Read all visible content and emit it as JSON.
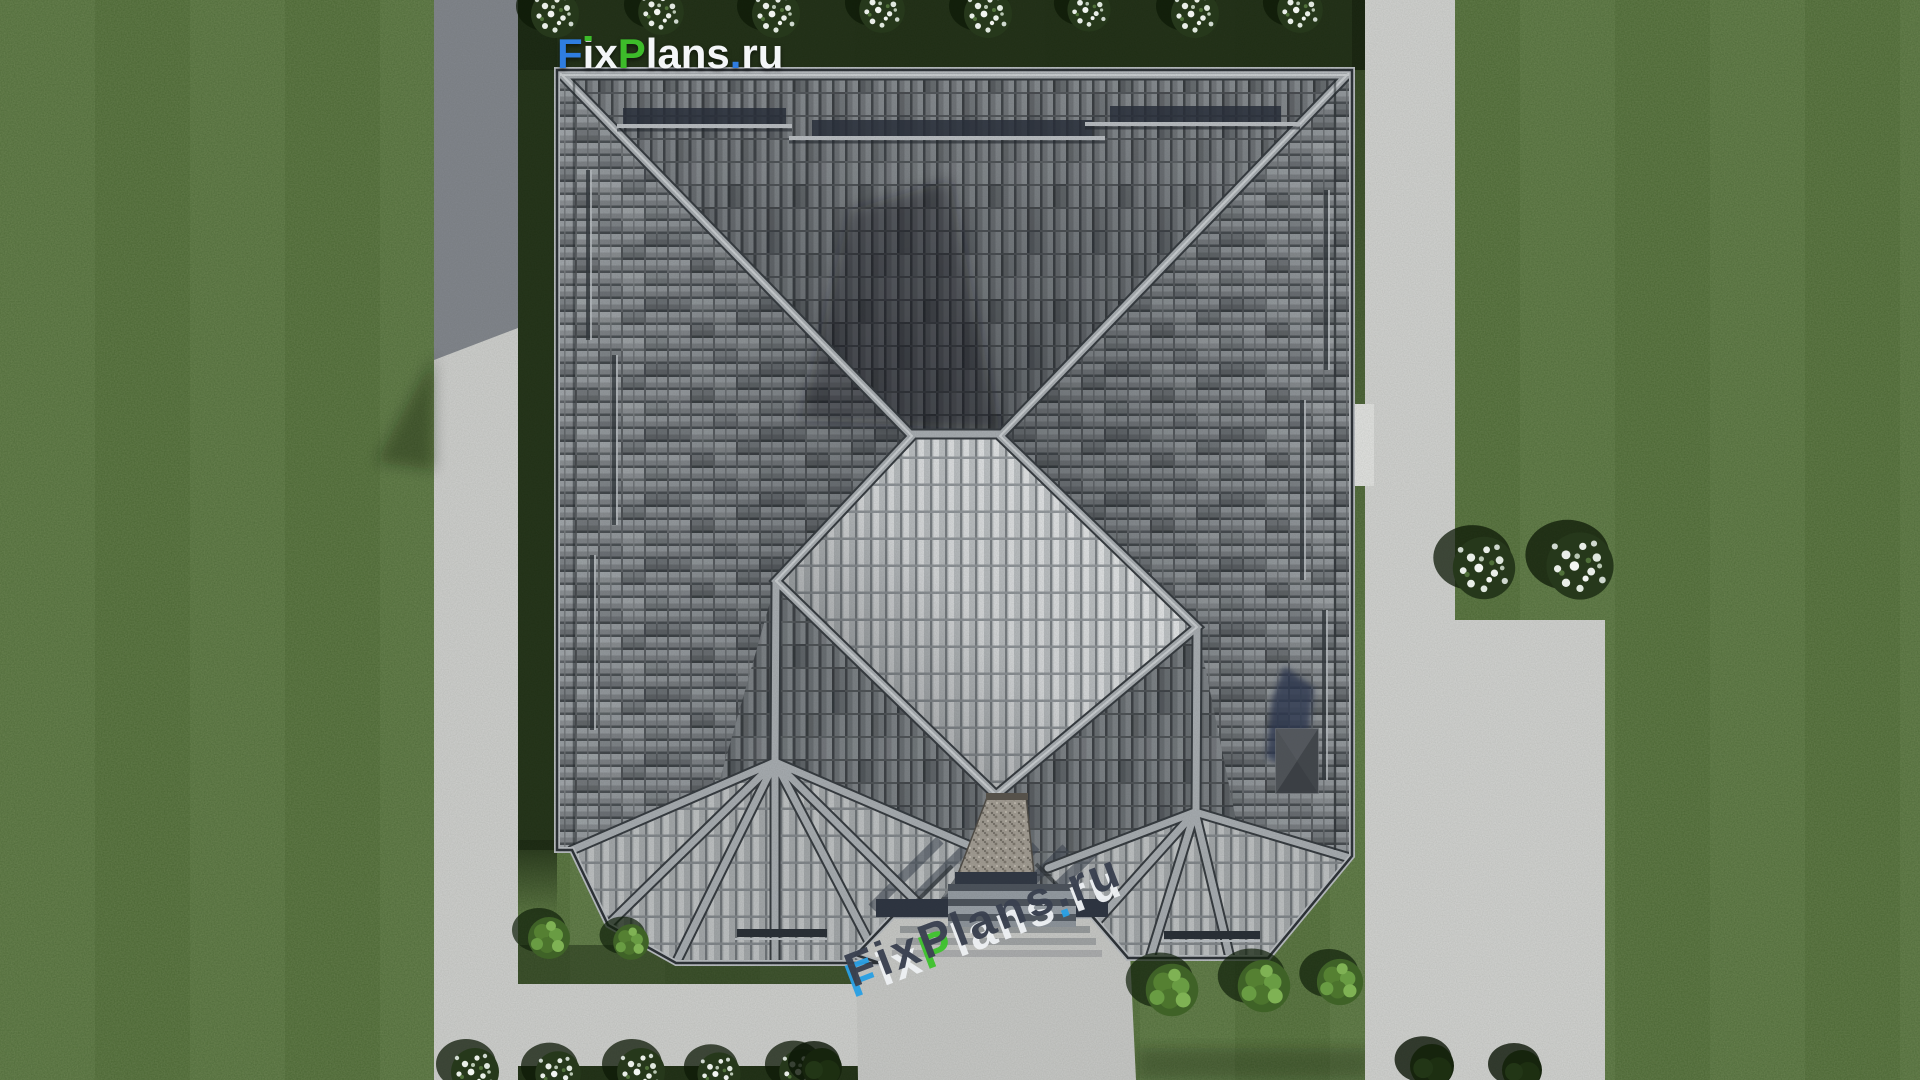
{
  "meta": {
    "site": "FixPlans.ru",
    "view": "top-down 3D render of a hip-roof house plot with lawn, walkways and driveway"
  },
  "logo": {
    "text": "FixPlans.ru",
    "segments": [
      {
        "text": "F",
        "color": "#2f7de0"
      },
      {
        "text": "i",
        "color": "#f4f6f8",
        "dot": "#3dbb2a"
      },
      {
        "text": "x",
        "color": "#f4f6f8"
      },
      {
        "text": "P",
        "color": "#3dbb2a"
      },
      {
        "text": "lans",
        "color": "#f4f6f8"
      },
      {
        "text": ".",
        "color": "#2f7de0"
      },
      {
        "text": "ru",
        "color": "#f4f6f8"
      }
    ]
  },
  "watermark": {
    "text": "FixPlans.ru",
    "top_color": "#3a4150",
    "segments": [
      {
        "text": "F",
        "color": "#3a4150",
        "front": "#2aa0e4"
      },
      {
        "text": "i",
        "color": "#3a4150",
        "front": "#eef1f4"
      },
      {
        "text": "x",
        "color": "#3a4150",
        "front": "#eef1f4"
      },
      {
        "text": "P",
        "color": "#3a4150",
        "front": "#3fc32e"
      },
      {
        "text": "l",
        "color": "#3a4150",
        "front": "#eef1f4"
      },
      {
        "text": "a",
        "color": "#3a4150",
        "front": "#eef1f4"
      },
      {
        "text": "n",
        "color": "#3a4150",
        "front": "#eef1f4"
      },
      {
        "text": "s",
        "color": "#3a4150",
        "front": "#eef1f4"
      },
      {
        "text": ".",
        "color": "#3a4150",
        "front": "#2aa0e4"
      },
      {
        "text": "r",
        "color": "#3a4150",
        "front": "#eef1f4"
      },
      {
        "text": "u",
        "color": "#3a4150",
        "front": "#eef1f4"
      }
    ]
  },
  "palette": {
    "grass": "#53713a",
    "grass_shadow": "#18260f",
    "walkway": "#cfd0ce",
    "walkway_in_shadow": "#878d9a",
    "driveway": "#d2d3d1",
    "entry_slab": "#c8c9c7",
    "roof_tile_dark": "#4b5055",
    "roof_tile_mid": "#82868b",
    "roof_tile_light": "#9ba0a5",
    "roof_ridge": "#a7acb1",
    "pavilion_tile": "#e6e8ea",
    "chimney_dark": "#45494f",
    "stone_chimney": "#a29c93",
    "shadow_navy": "#2a3550"
  }
}
